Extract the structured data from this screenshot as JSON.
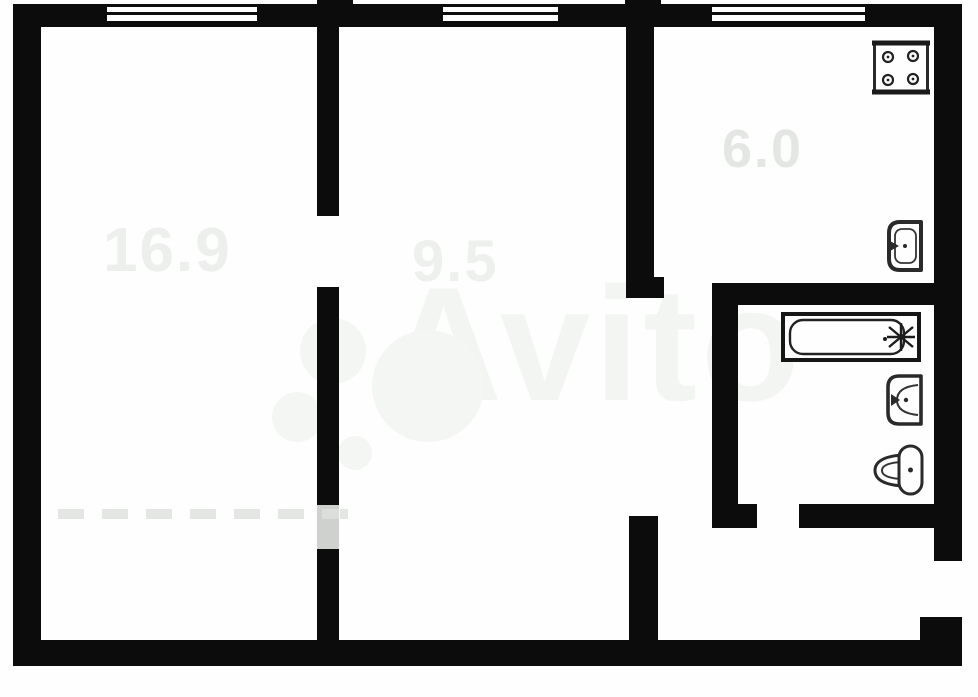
{
  "plan": {
    "title": "two-room apartment floor plan",
    "watermark": {
      "brand": "Avito"
    },
    "rooms": [
      {
        "id": "living-room",
        "area_label": "16.9"
      },
      {
        "id": "middle-room",
        "area_label": "9.5"
      },
      {
        "id": "kitchen",
        "area_label": "6.0"
      }
    ],
    "fixtures": [
      {
        "id": "stove",
        "icon": "stove-icon"
      },
      {
        "id": "kitchen-sink",
        "icon": "kitchen-sink-icon"
      },
      {
        "id": "bathtub",
        "icon": "bathtub-icon"
      },
      {
        "id": "washbasin",
        "icon": "washbasin-icon"
      },
      {
        "id": "toilet",
        "icon": "toilet-icon"
      }
    ],
    "colors": {
      "wall": "#0c0c0c",
      "label_faint": "#e7eae7",
      "watermark": "#f3f5f2"
    }
  }
}
